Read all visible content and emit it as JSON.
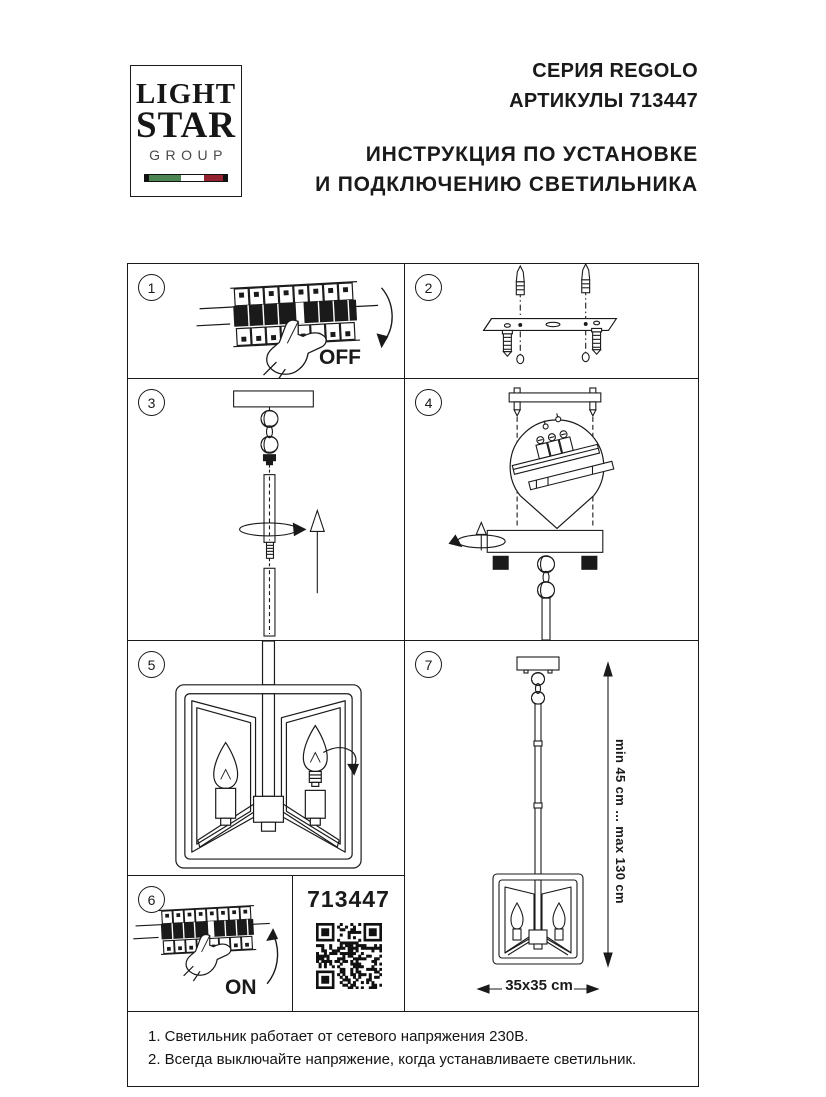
{
  "header": {
    "logo": {
      "line1": "LIGHT",
      "line2": "STAR",
      "line3": "GROUP"
    },
    "series": "СЕРИЯ REGOLO",
    "articles": "АРТИКУЛЫ 713447",
    "title_line1": "ИНСТРУКЦИЯ ПО УСТАНОВКЕ",
    "title_line2": "И ПОДКЛЮЧЕНИЮ СВЕТИЛЬНИКА"
  },
  "steps": {
    "s1": {
      "number": "1",
      "label": "OFF"
    },
    "s2": {
      "number": "2"
    },
    "s3": {
      "number": "3"
    },
    "s4": {
      "number": "4"
    },
    "s5": {
      "number": "5"
    },
    "s6": {
      "number": "6",
      "label": "ON"
    },
    "s7": {
      "number": "7",
      "height_range": "min 45 cm ... max 130 cm",
      "base_size": "35x35 cm"
    }
  },
  "qr_panel": {
    "article": "713447",
    "icon": "qr-code-icon"
  },
  "notes": {
    "line1": "1. Светильник работает от сетевого напряжения 230В.",
    "line2": "2. Всегда выключайте напряжение, когда устанавливаете светильник."
  },
  "colors": {
    "ink": "#1a1a1a",
    "flag_green": "#4a8552",
    "flag_red": "#94212e"
  }
}
